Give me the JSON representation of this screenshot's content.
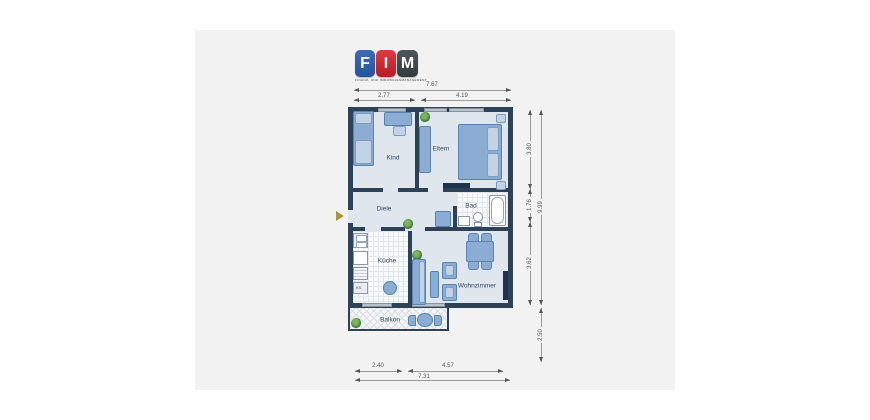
{
  "logo": {
    "letter_f": "F",
    "letter_i": "I",
    "letter_m": "M",
    "tagline": "FINANZ- UND IMMOBILIENMANAGEMENT",
    "colors": {
      "f_tile": "#2a5fa9",
      "i_tile": "#d2232a",
      "m_tile": "#41494d"
    }
  },
  "floorplan": {
    "rooms": {
      "kind": {
        "label": "Kind"
      },
      "eltern": {
        "label": "Eltern"
      },
      "diele": {
        "label": "Diele"
      },
      "bad": {
        "label": "Bad"
      },
      "kueche": {
        "label": "Küche"
      },
      "wohnzimmer": {
        "label": "Wohnzimmer"
      },
      "balkon": {
        "label": "Balkon"
      }
    },
    "fridge_label": "KS",
    "dimensions": {
      "top_total": "7.67",
      "top_left": "2.77",
      "top_right": "4.19",
      "right_upper": "3.80",
      "right_middle": "1.76",
      "right_lower": "3.62",
      "right_total": "9.99",
      "right_extension": "2.50",
      "bottom_left": "2.40",
      "bottom_right": "4.57",
      "bottom_total": "7.31"
    },
    "colors": {
      "wall": "#2e4257",
      "floor": "#dfe6ee",
      "furniture": "#8badd3",
      "tile_floor": "#f7f9fa",
      "plant": "#3f7d3b",
      "entrance_arrow": "#a8973a",
      "window": "#b7c1ca",
      "radiator": "#1d3350"
    }
  }
}
